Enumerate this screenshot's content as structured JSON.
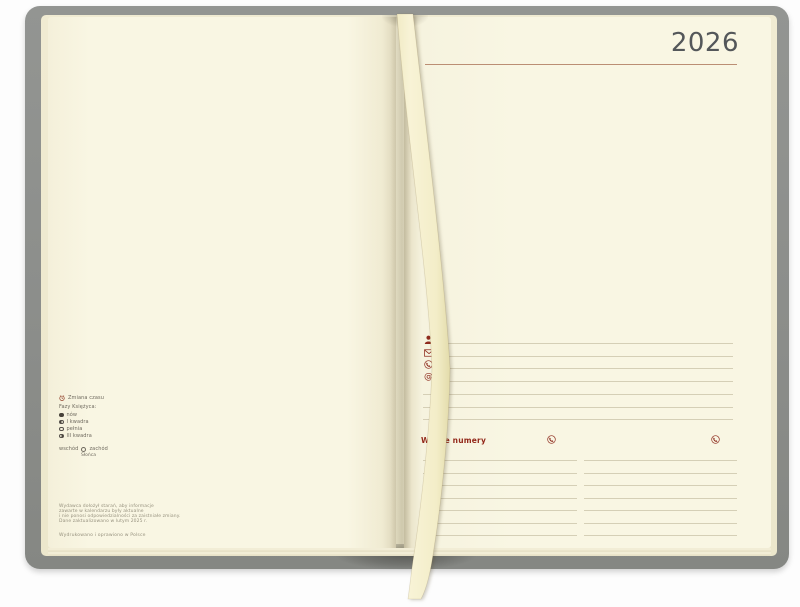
{
  "right_page": {
    "year": "2026",
    "important_numbers_heading": "Ważne numery",
    "at_symbol": "@",
    "personal_field_icons": [
      "person",
      "envelope",
      "phone",
      "email"
    ]
  },
  "left_page": {
    "legend": {
      "time_change_label": "Zmiana czasu",
      "moon_heading": "Fazy Księżyca:",
      "moon_phases": [
        {
          "icon": "new-moon",
          "label": "nów"
        },
        {
          "icon": "first-quarter",
          "label": "I kwadra"
        },
        {
          "icon": "full-moon",
          "label": "pełnia"
        },
        {
          "icon": "third-quarter",
          "label": "III kwadra"
        }
      ],
      "sunrise_label": "wschód",
      "sunset_label": "zachód",
      "sun_subject": "Słońca"
    },
    "disclaimer_lines": [
      "Wydawca dołożył starań, aby informacje",
      "zawarte w kalendarzu były aktualne",
      "i nie ponosi odpowiedzialności za zaistniałe zmiany.",
      "Dane zaktualizowano w lutym 2025 r."
    ],
    "printed_note": "Wydrukowano i oprawiono w Polsce"
  },
  "colors": {
    "accent_red": "#8e2b1d",
    "page_cream": "#f9f6e3",
    "cover_gray": "#8c8e8b",
    "ruled_line": "#d5cfb6",
    "year_gray": "#54575a",
    "ribbon": "#f5efcb"
  }
}
